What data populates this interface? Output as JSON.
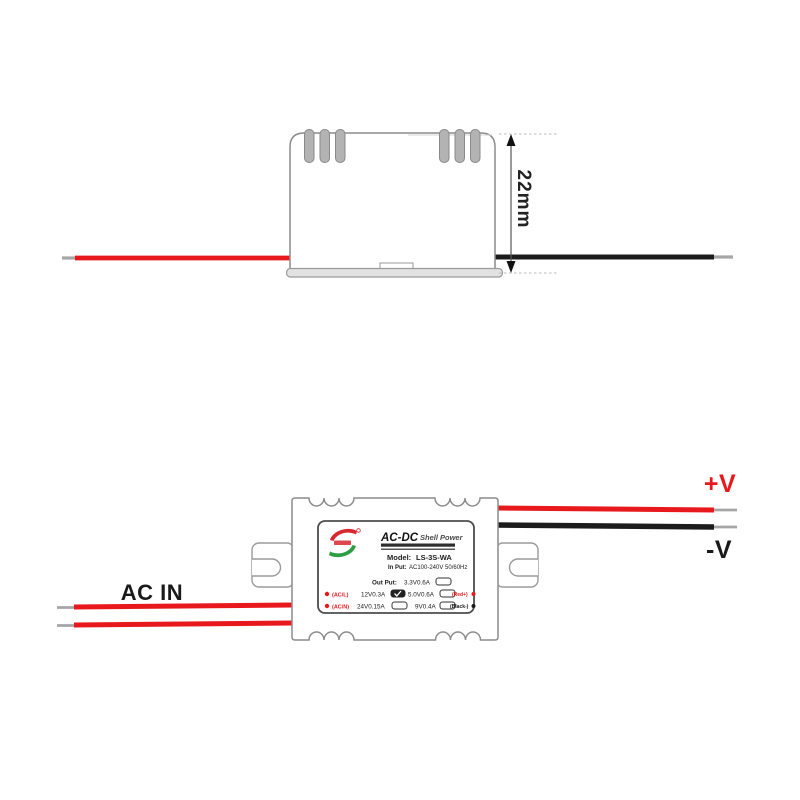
{
  "side_view": {
    "height_dimension": "22mm"
  },
  "top_view": {
    "ac_in": "AC IN",
    "v_plus": "+V",
    "v_minus": "-V",
    "label": {
      "title": "AC-DC",
      "title_suffix": "Shell Power",
      "model_label": "Model:",
      "model": "LS-3S-WA",
      "input_label": "In Put:",
      "input": "AC100-240V 50/60Hz",
      "output_label": "Out Put:",
      "options": [
        {
          "value": "3.3V0.6A",
          "checked": false
        },
        {
          "value": "12V0.3A",
          "checked": true
        },
        {
          "value": "5.0V0.6A",
          "checked": false
        },
        {
          "value": "24V0.15A",
          "checked": false
        },
        {
          "value": "9V0.4A",
          "checked": false
        }
      ],
      "terminal_left_1": "(AC/L)",
      "terminal_left_2": "(AC/N)",
      "terminal_right_1": "(Red+)",
      "terminal_right_2": "(Black-)"
    }
  },
  "colors": {
    "wire_red": "#e8191c",
    "wire_black": "#1c1c1c",
    "wire_tip_gray": "#a6a6a6",
    "outline_gray": "#8c8c8c",
    "logo_red": "#d7282f",
    "logo_green": "#2e9e44"
  }
}
